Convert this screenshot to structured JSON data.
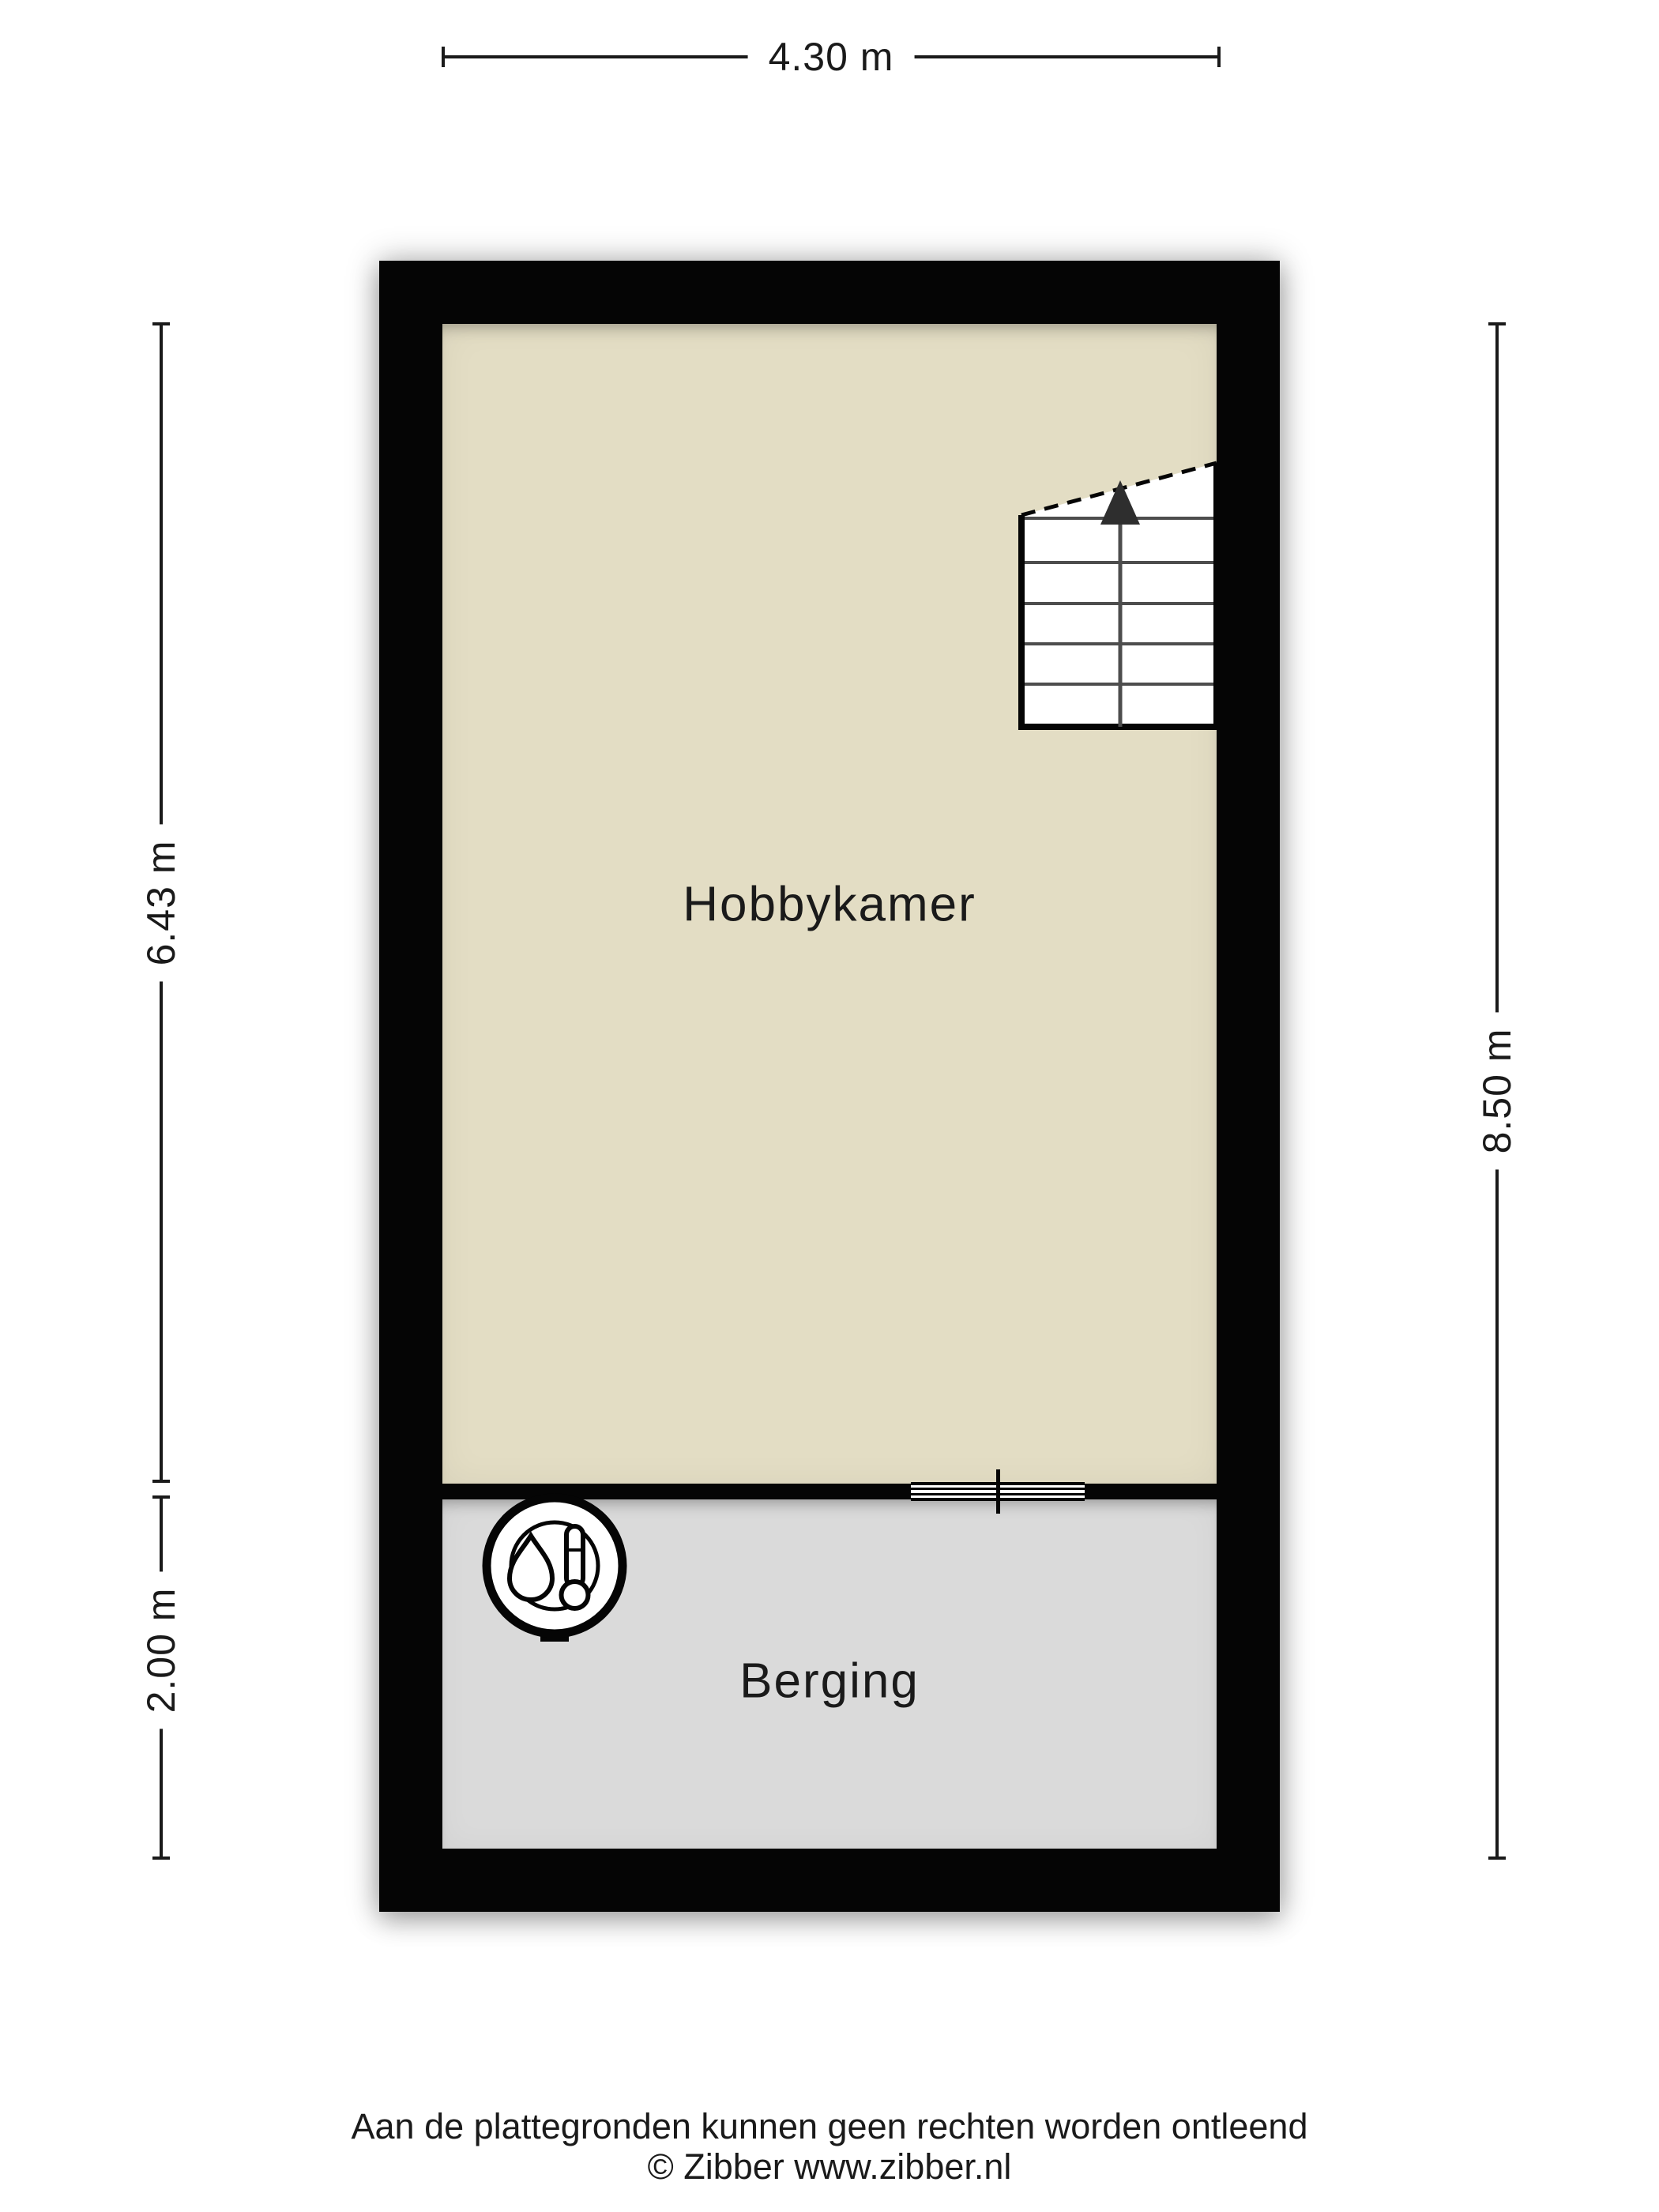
{
  "floorplan": {
    "dimensions": {
      "top": "4.30 m",
      "left_upper": "6.43 m",
      "left_lower": "2.00 m",
      "right": "8.50 m"
    },
    "rooms": [
      {
        "name": "Hobbykamer",
        "floor_color": "#e3ddc4"
      },
      {
        "name": "Berging",
        "floor_color": "#dadada"
      }
    ],
    "features": [
      {
        "icon": "staircase-up-arrow-icon"
      },
      {
        "icon": "boiler-thermometer-icon"
      },
      {
        "icon": "door-threshold-icon"
      }
    ]
  },
  "colors": {
    "wall": "#050505",
    "line": "#1a1a1a",
    "text": "#1a1a1a",
    "hobby_floor": "#e3ddc4",
    "berging_floor": "#dadada",
    "stair_tread": "#4d4d4d"
  },
  "footer": {
    "disclaimer": "Aan de plattegronden kunnen geen rechten worden ontleend",
    "copyright": "© Zibber www.zibber.nl"
  }
}
